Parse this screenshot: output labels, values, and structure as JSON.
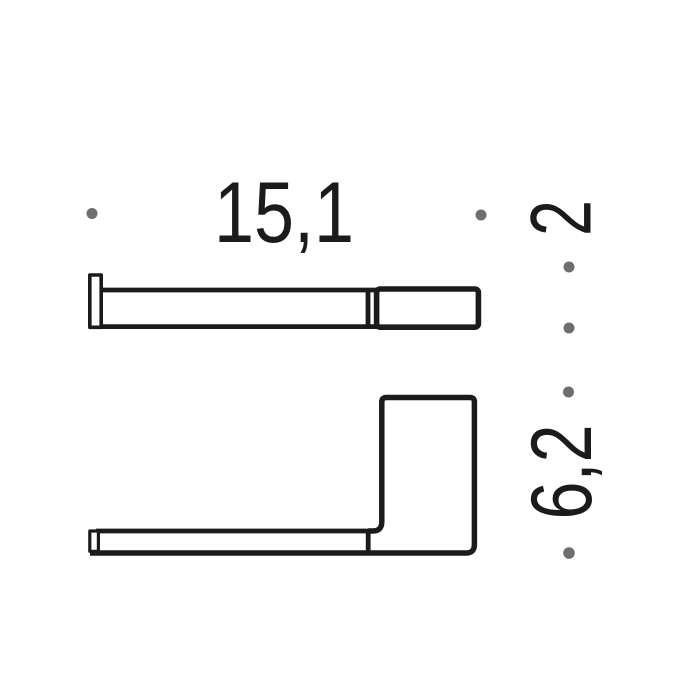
{
  "dimensions": {
    "width_label": "15,1",
    "depth_label": "2",
    "height_label": "6,2"
  },
  "colors": {
    "line": "#1b1b1b",
    "dot": "#6e6e6e",
    "background": "#ffffff"
  }
}
